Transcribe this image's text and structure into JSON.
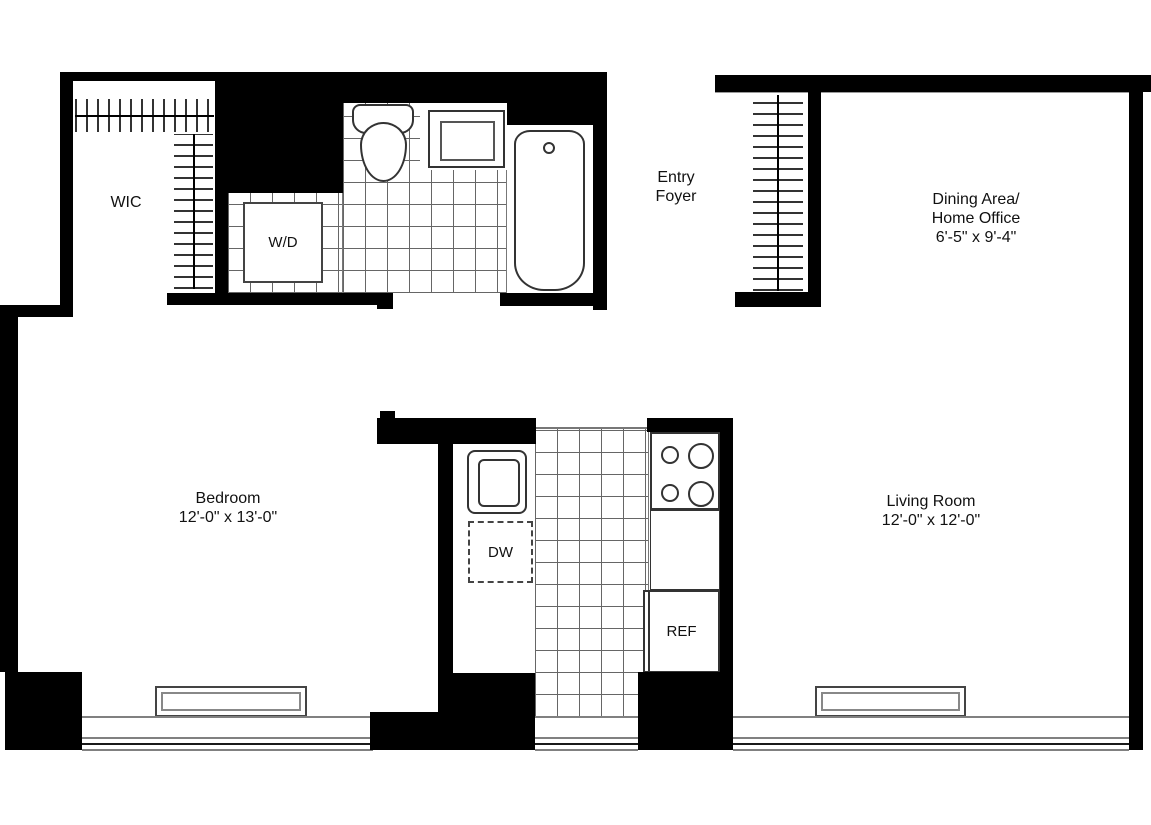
{
  "labels": {
    "wic": "WIC",
    "wd": "W/D",
    "entry_foyer": [
      "Entry",
      "Foyer"
    ],
    "dining": [
      "Dining Area/",
      "Home Office",
      "6'-5\" x 9'-4\""
    ],
    "bedroom": [
      "Bedroom",
      "12'-0\" x 13'-0\""
    ],
    "living": [
      "Living Room",
      "12'-0\" x 12'-0\""
    ],
    "dishwasher": "DW",
    "refrigerator": "REF"
  },
  "colors": {
    "wall": "#000000",
    "fixture_line": "#333333",
    "tile_line": "#666666",
    "window_line": "#808080",
    "text": "#111111"
  }
}
